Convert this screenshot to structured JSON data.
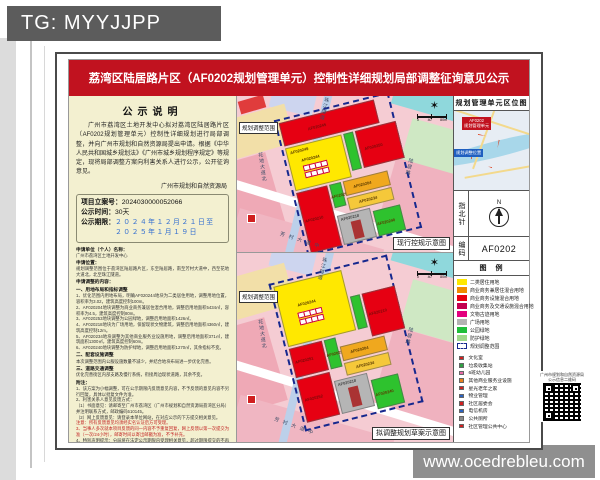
{
  "watermark_top": "TG: MYYJJPP",
  "watermark_bottom": "www.ocedrebleu.com",
  "title": "荔湾区陆居路片区（AF0202规划管理单元）控制性详细规划局部调整征询意见公示",
  "notice": {
    "heading": "公示说明",
    "body": "广州市荔湾区土地开发中心拟对荔湾区陆居路片区（AF0202规划管理单元）控制性详细规划进行局部调整，并向广州市规划和自然资源局提出申请。根据《中华人民共和国城乡规划法》《广州市城乡规划程序规定》等规定，现将局部调整方案向利害关系人进行公示，公开征询意见。",
    "signature": "广州市规划和自然资源局",
    "case_label": "项目立案号：",
    "case_no": "2024030000052066",
    "time_label": "公示时间：",
    "time_value": "30天",
    "period_label": "公示期限：",
    "period_line1": "２０２４年１２月２１日至",
    "period_line2": "２０２５年１月１９日",
    "lines": [
      {
        "t": "申请单位（个人）名称：",
        "c": "b"
      },
      {
        "t": "广州市荔湾区土地开发中心",
        "c": ""
      },
      {
        "t": "申请位置：",
        "c": "b"
      },
      {
        "t": "规划调整范围位于荔湾区陆居路片区，东至陆居路，南至芳村大道中，西至花地大道北，北至珠江隧道。",
        "c": ""
      },
      {
        "t": "申请调整的内容：",
        "c": "b"
      },
      {
        "t": "一、用地布局和指标调整",
        "c": "b"
      },
      {
        "t": "1、优化范围内用地布局，明确AF020244地块为二类居住用地，调整用地位置，容积率为3.02，建筑高度控制100m。",
        "c": ""
      },
      {
        "t": "2、AF020204地块调整为商业商务兼居住混合用地，调整后用地面积5434㎡，容积率为4.5，建筑高度控制80m。",
        "c": ""
      },
      {
        "t": "3、AF020253地块调整为公园绿地，调整后用地面积1426㎡。",
        "c": ""
      },
      {
        "t": "4、AF020218地块为广场用地，保留现状文物建筑，调整后用地面积4360㎡，建筑高度控制12m。",
        "c": ""
      },
      {
        "t": "5、AF020234地块调整为其他商业服务业设施用地，调整后用地面积371㎡，建筑面积1300㎡，建筑高度控制60m。",
        "c": ""
      },
      {
        "t": "6、AF020240地块调整为防护绿地，调整后用地面积1270㎡，其余指标不变。",
        "c": ""
      },
      {
        "t": "二、配套设施调整",
        "c": "b"
      },
      {
        "t": "本次调整范围内公服设施数量不减少，并结合地块布局进一步优化完善。",
        "c": ""
      },
      {
        "t": "三、道路交通调整",
        "c": "b"
      },
      {
        "t": "优化完善街区内部支路及慢行系统，衔接周边现状道路，其余不变。",
        "c": ""
      },
      {
        "t": "附注：",
        "c": "b"
      },
      {
        "t": "1、该方案为小幅调整，可在公示期限内反馈意见内容，不予反馈的意见内容不另行回复，具体以批复文件为准。",
        "c": ""
      },
      {
        "t": "2、利害关系人意见反馈方式：",
        "c": ""
      },
      {
        "t": "（1）书面意见：请邮寄至广州市荔湾区（广州市规划和自然资源局荔湾区分局）并注明联系方式，邮政编码510145。",
        "c": ""
      },
      {
        "t": "（2）网上反馈意见：请登录本单位网站，在对应公示的下方提交相关意见。",
        "c": ""
      },
      {
        "t": "注意：所有反馈意见均须经实名认证后方可受理。",
        "c": "r"
      },
      {
        "t": "3、当事人多次就本项目反馈的同一内容不予重复回复，网上反馈以第一次提交为准（一次/24小时），邮寄时间以寄出邮戳为准，不予补充。",
        "c": "r"
      },
      {
        "t": "4、特别声明提示：分局将在法定公示期限内受理相关意见，超过期限提交的不再作为本次公示意见处理。",
        "c": ""
      },
      {
        "t": "5、查询网址：",
        "c": ""
      },
      {
        "t": "http://ghzyj.gz.gov.cn/zwgk/csgh/ghgkgzgh/zsgs/",
        "c": "u"
      }
    ]
  },
  "maps": {
    "scale_nums": {
      "n0": "0",
      "n1": "40",
      "n2": "80m"
    },
    "current": {
      "caption": "现行控规示意图",
      "range_tag": "规划调整范围",
      "streets": {
        "tunnel": "珠江隧道",
        "west": "花地大道北",
        "south": "芳村大道中",
        "east": "陆居路"
      },
      "ids": {
        "top": "AF020245",
        "y249": "AF020249",
        "y244": "AF020244",
        "right": "AF020250",
        "left": "AF020210",
        "g": "AF020253",
        "o1": "AF020204",
        "o2": "AF020234",
        "gray": "AF020218",
        "g2": "AF020240"
      }
    },
    "proposed": {
      "caption": "拟调整规划草案示意图",
      "range_tag": "规划调整范围",
      "streets": {
        "tunnel": "珠江隧道",
        "west": "花地大道北",
        "south": "芳村大道中",
        "east": "陆居路"
      },
      "ids": {
        "y244": "AF020244",
        "right": "AF020210",
        "left1": "AF020251",
        "left2": "AF020252",
        "g": "AF020253",
        "o1": "AF020204",
        "o2": "AF020234",
        "gray": "AF020218",
        "g2": "AF020240"
      }
    }
  },
  "unit_panel": {
    "location_header": "规划管理单元区位图",
    "tag_red1": "AF0202",
    "tag_red2": "规划管理单元",
    "tag_blue": "规划调整位置",
    "compass_label": "指北针",
    "north": "N",
    "code_label": "编码",
    "code": "AF0202",
    "legend_header": "图　例",
    "legend": [
      {
        "label": "二类居住用地",
        "color": "#ffe800"
      },
      {
        "label": "商业商务兼居住混合用地",
        "color": "#f08c00"
      },
      {
        "label": "商业商务设施混合用地",
        "color": "#e60012"
      },
      {
        "label": "商业商务及交通设施混合用地",
        "color": "#c4004f"
      },
      {
        "label": "文物古迹用地",
        "color": "#e4007f"
      },
      {
        "label": "广场用地",
        "color": "#b3b3b3"
      },
      {
        "label": "公园绿地",
        "color": "#1fbf3a"
      },
      {
        "label": "防护绿地",
        "color": "#9ed98a"
      },
      {
        "label": "规划调整范围",
        "color": "#ffffff",
        "border": "1.5px dashed #16288e"
      }
    ],
    "facilities": [
      {
        "label": "文化室",
        "icon": "#d02020"
      },
      {
        "label": "垃圾收集站",
        "icon": "#2f9e44"
      },
      {
        "label": "6班幼儿园",
        "icon": "#e86aa6"
      },
      {
        "label": "其他商业服务业设施",
        "icon": "#e8821e"
      },
      {
        "label": "星光老年之家",
        "icon": "#c22"
      },
      {
        "label": "物业管理",
        "icon": "#2a62c0"
      },
      {
        "label": "社区居委会",
        "icon": "#d02020"
      },
      {
        "label": "电信机房",
        "icon": "#2a62c0"
      },
      {
        "label": "公共厕所",
        "icon": "#8a8a8a"
      },
      {
        "label": "社区管理公共中心",
        "icon": "#d02020"
      }
    ]
  },
  "qr": {
    "line1": "广州市规划和自然资源局",
    "line2": "公示信息二维码"
  }
}
